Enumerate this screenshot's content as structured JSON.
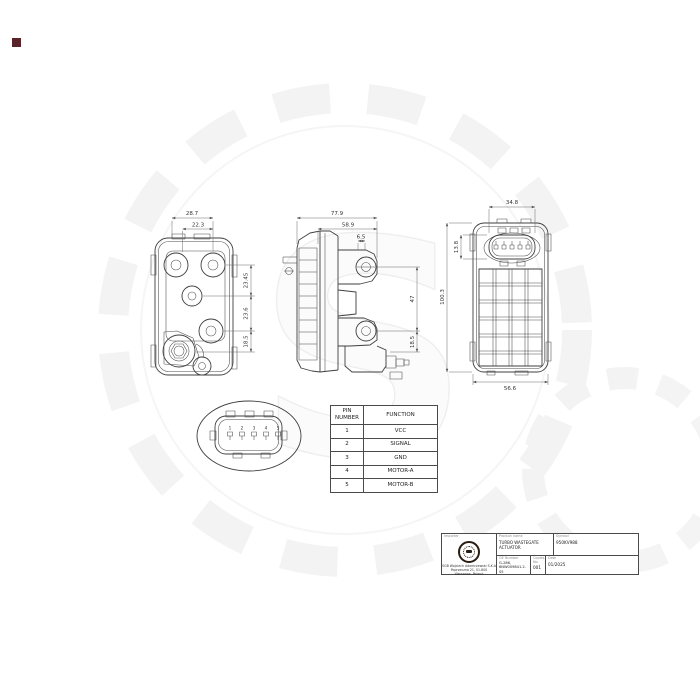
{
  "drawing": {
    "views": {
      "rear": {
        "dims": {
          "width_outer": "28.7",
          "width_inner": "22.3",
          "right_top": "23.45",
          "right_mid": "23.6",
          "right_bottom": "18.5"
        }
      },
      "side": {
        "dims": {
          "width_outer": "77.9",
          "width_inner": "58.9",
          "offset": "6.5",
          "hole_span": "47",
          "lower": "18.5"
        }
      },
      "front": {
        "dims": {
          "conn_width": "34.8",
          "conn_height": "13.8",
          "width": "56.6"
        }
      },
      "shared": {
        "height": "100.3"
      },
      "connector_detail": {
        "pins": [
          "1",
          "2",
          "3",
          "4",
          "5"
        ]
      }
    },
    "pin_table": {
      "col1_header": "PIN NUMBER",
      "col2_header": "FUNCTION",
      "rows": [
        {
          "pin": "1",
          "function": "VCC"
        },
        {
          "pin": "2",
          "function": "SIGNAL"
        },
        {
          "pin": "3",
          "function": "GND"
        },
        {
          "pin": "4",
          "function": "MOTOR-A"
        },
        {
          "pin": "5",
          "function": "MOTOR-B"
        }
      ]
    },
    "title_block": {
      "logo_label": "Importer",
      "company_line1": "SGB Wojciech Adamczewski S.K.A",
      "company_line2": "Poprzeczna 21, 01-800 Warszawa, Poland",
      "company_line3": "info@sgt.waw.pl",
      "product_label": "Product name",
      "product_value": "TURBO WASTEGATE ACTUATOR",
      "symbol_label": "Symbol",
      "symbol_value": "950KV988",
      "oe_label": "OE Number",
      "oe_value_line1": "G-286,",
      "oe_value_line2": "6NW009841.2-S5",
      "copies_label": "Copies No.",
      "copies_value": "001",
      "date_label": "Date",
      "date_value": "01/2025"
    }
  }
}
